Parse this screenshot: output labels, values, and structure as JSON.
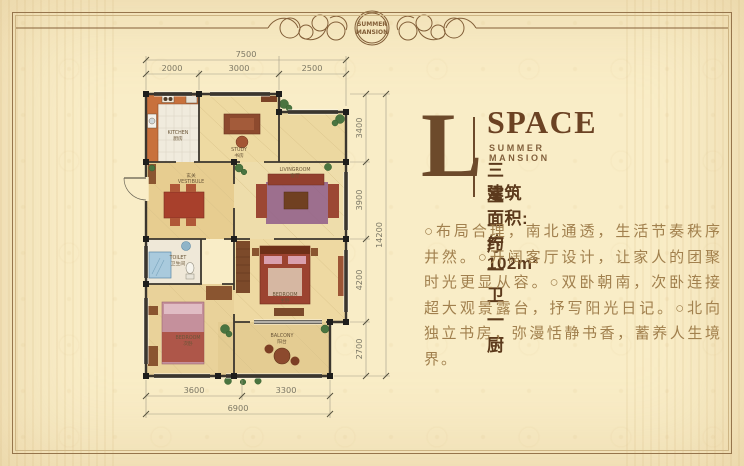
{
  "header": {
    "medallion_line1": "SUMMER",
    "medallion_line2": "MANSION"
  },
  "info": {
    "letter": "L",
    "title": "SPACE",
    "subtitle": "SUMMER MANSION",
    "layout": "三室二厅一卫一厨",
    "area": "建筑面积:约102m²",
    "description": "○布局合理，南北通透，生活节奏秩序井然。○开阔客厅设计，让家人的团聚时光更显从容。○双卧朝南，次卧连接超大观景露台，抒写阳光日记。○北向独立书房，弥漫恬静书香，蓄养人生境界。"
  },
  "floorplan": {
    "dims": {
      "top_total": "7500",
      "top_segments": [
        "2000",
        "3000",
        "2500"
      ],
      "bottom_segments": [
        "3600",
        "3300"
      ],
      "bottom_total": "6900",
      "right_segments": [
        "3400",
        "3900",
        "4200",
        "2700"
      ],
      "right_total": "14200"
    },
    "rooms": {
      "kitchen": {
        "en": "KITCHEN",
        "zh": "厨房"
      },
      "study": {
        "en": "STUDY",
        "zh": "书房"
      },
      "vestibule": {
        "zh": "玄关",
        "en": "VESTIBULE"
      },
      "living": {
        "en": "LIVINGROOM",
        "zh": "客厅"
      },
      "toilet": {
        "en": "TOILET",
        "zh": "卫生间"
      },
      "bedroom2": {
        "en": "BEDROOM",
        "zh": "次卧"
      },
      "master": {
        "en": "BEDROOM",
        "zh": "主卧"
      },
      "balcony": {
        "en": "BALCONY",
        "zh": "阳台"
      }
    }
  },
  "colors": {
    "bg": "#f9edc7",
    "accent_brown": "#6d4a2b",
    "frame": "#96754c",
    "body_text": "#a1804e"
  }
}
